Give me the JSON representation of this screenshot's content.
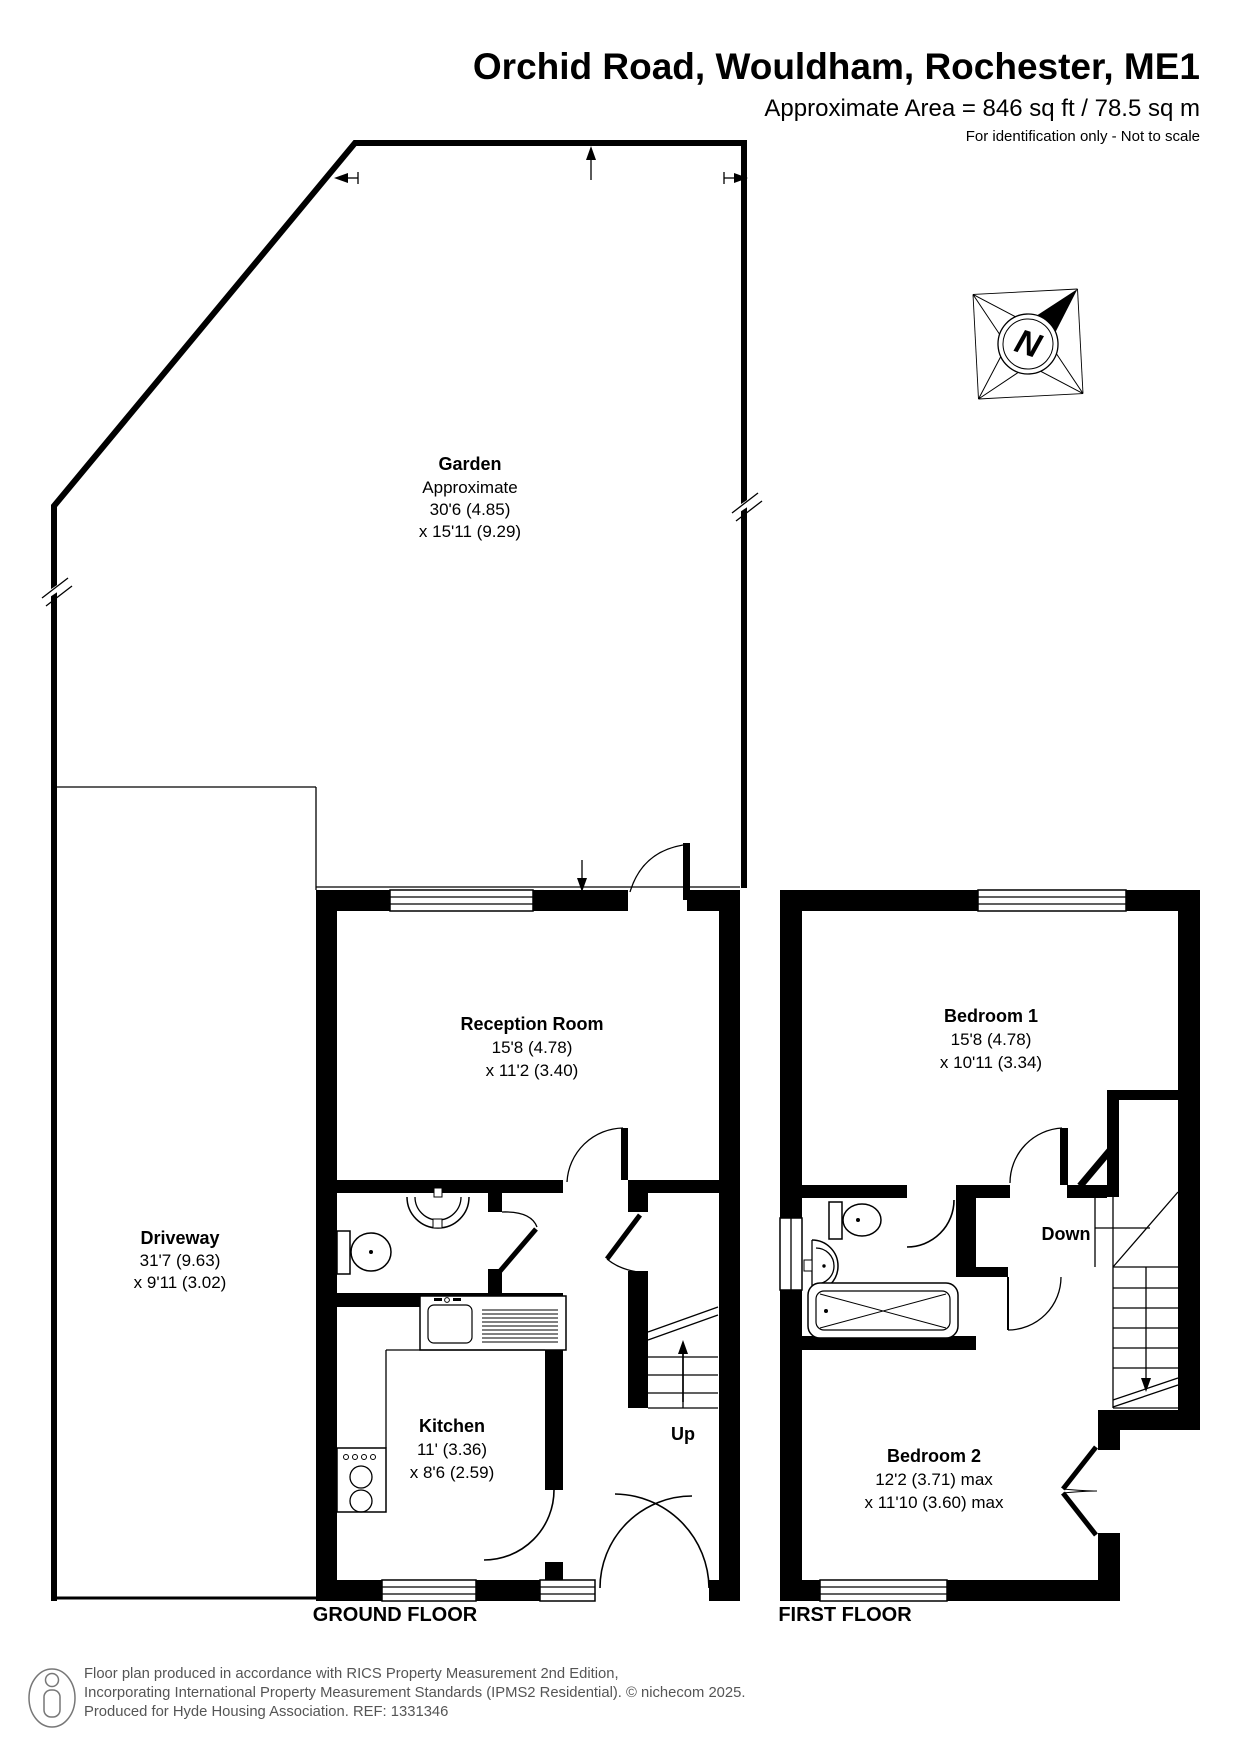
{
  "header": {
    "title": "Orchid Road, Wouldham, Rochester, ME1",
    "area": "Approximate Area = 846 sq ft / 78.5 sq m",
    "note": "For identification only - Not to scale"
  },
  "garden": {
    "name": "Garden",
    "approx": "Approximate",
    "dim1": "30'6 (4.85)",
    "dim2": "x 15'11 (9.29)"
  },
  "driveway": {
    "name": "Driveway",
    "dim1": "31'7 (9.63)",
    "dim2": "x 9'11 (3.02)"
  },
  "ground_floor": {
    "label": "GROUND FLOOR",
    "reception": {
      "name": "Reception Room",
      "dim1": "15'8 (4.78)",
      "dim2": "x 11'2 (3.40)"
    },
    "kitchen": {
      "name": "Kitchen",
      "dim1": "11' (3.36)",
      "dim2": "x 8'6 (2.59)"
    },
    "stairs_label": "Up"
  },
  "first_floor": {
    "label": "FIRST FLOOR",
    "bedroom1": {
      "name": "Bedroom 1",
      "dim1": "15'8 (4.78)",
      "dim2": "x 10'11 (3.34)"
    },
    "bedroom2": {
      "name": "Bedroom 2",
      "dim1": "12'2 (3.71) max",
      "dim2": "x 11'10 (3.60) max"
    },
    "stairs_label": "Down"
  },
  "compass": {
    "letter": "N"
  },
  "footer": {
    "line1": "Floor plan produced in accordance with RICS Property Measurement 2nd Edition,",
    "line2": "Incorporating International Property Measurement Standards (IPMS2 Residential).   © nichecom 2025.",
    "line3": "Produced for Hyde Housing Association.  REF: 1331346"
  },
  "colors": {
    "plan": "#000000",
    "footer_text": "#555555"
  }
}
